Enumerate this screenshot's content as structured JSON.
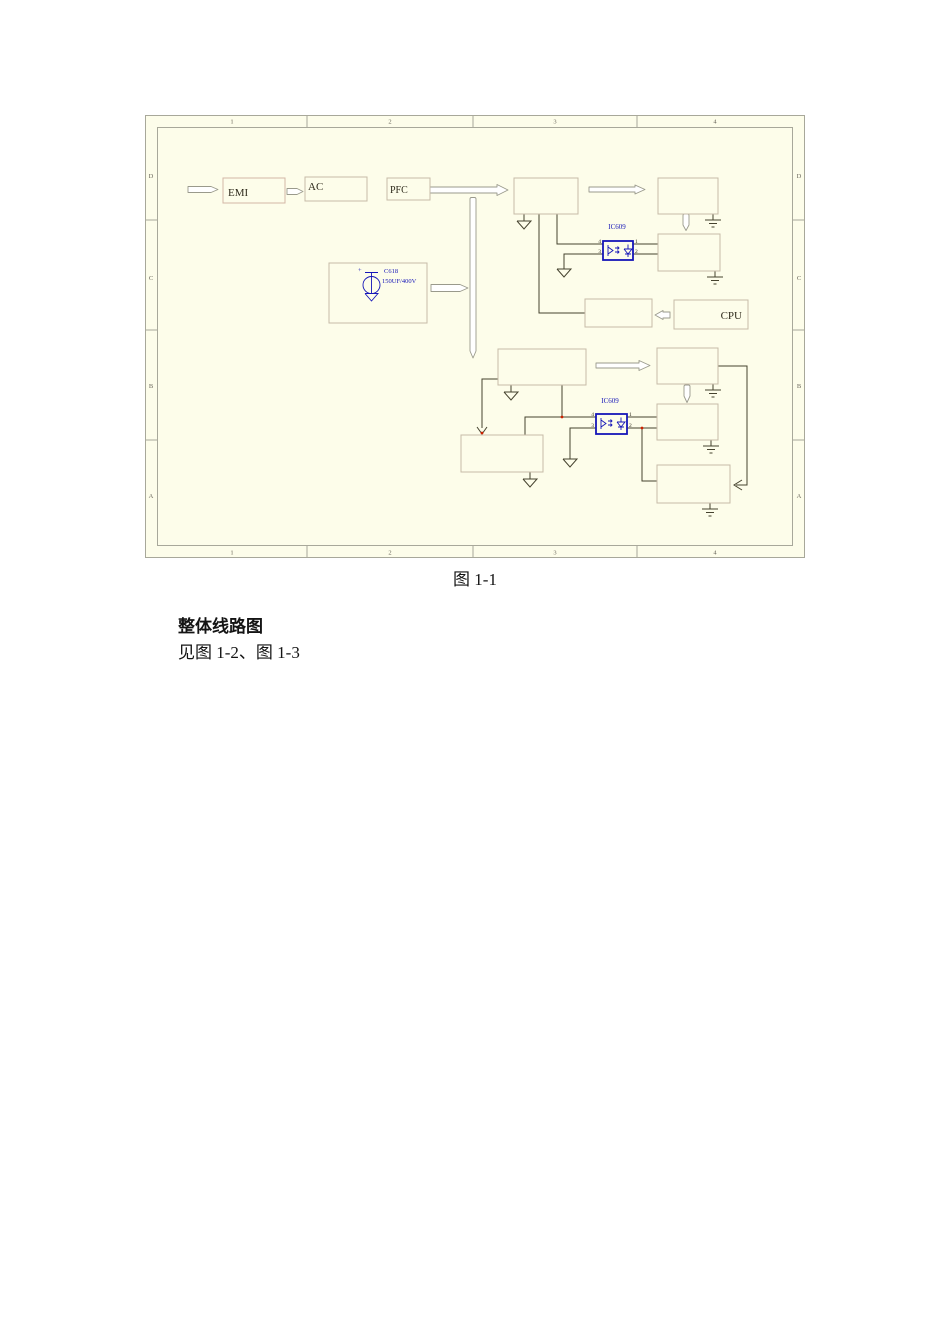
{
  "document": {
    "figure_caption": "图 1-1",
    "section_heading": "整体线路图",
    "section_text": "见图 1-2、图 1-3"
  },
  "schematic": {
    "border": {
      "columns": [
        "1",
        "2",
        "3",
        "4"
      ],
      "rows": [
        "D",
        "C",
        "B",
        "A"
      ]
    },
    "blocks": {
      "emi": "EMI",
      "ac": "AC",
      "pfc": "PFC",
      "cpu": "CPU"
    },
    "optocoupler_top": {
      "ref": "IC609",
      "pin_4": "4",
      "pin_3": "3",
      "pin_1": "1",
      "pin_2": "2"
    },
    "optocoupler_bottom": {
      "ref": "IC609",
      "pin_4": "4",
      "pin_3": "3",
      "pin_1": "1",
      "pin_2": "2"
    },
    "capacitor": {
      "ref": "C618",
      "value": "150UF/400V",
      "polarity": "+"
    },
    "colors": {
      "canvas": "#fdfdea",
      "frame": "#a8a89a",
      "box_border": "#c6bba8",
      "emi_box_border": "#d4b6a6",
      "wire": "#45422e",
      "blue": "#1616b8",
      "junction_dot": "#cc2200"
    }
  }
}
